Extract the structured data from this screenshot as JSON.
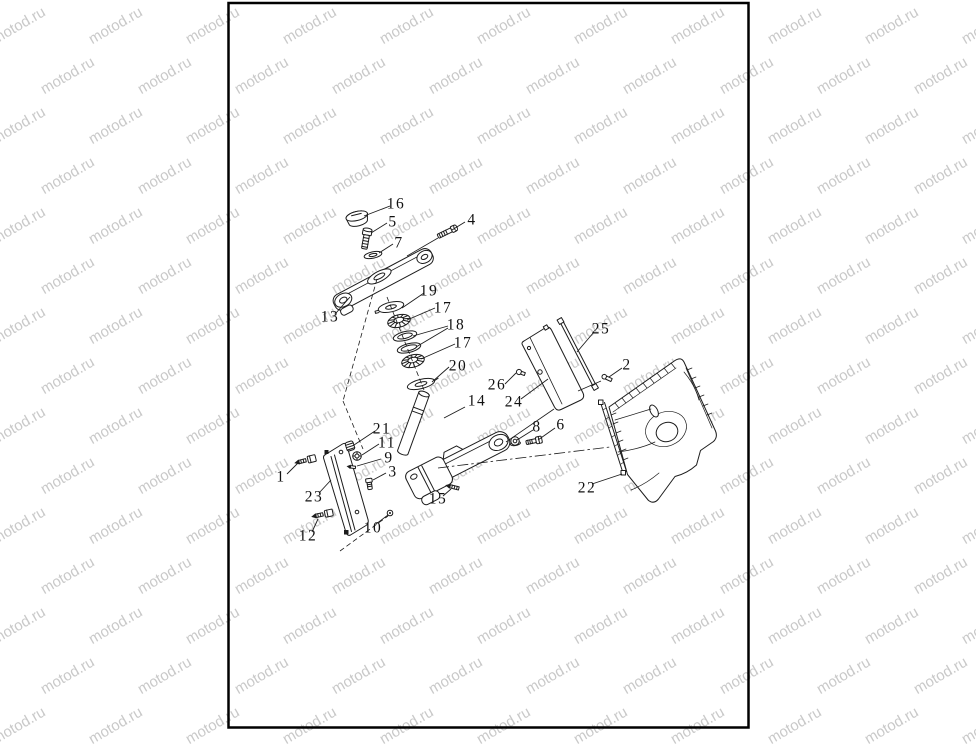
{
  "watermark": {
    "text": "motod.ru",
    "color": "#c9c9c9",
    "font_size": 15,
    "angle_deg": -30,
    "col_step": 97,
    "row_step": 50,
    "row_offset": 48,
    "cols": 12,
    "rows": 16,
    "x0": -55,
    "y0": -18
  },
  "page": {
    "background": "#ffffff",
    "border_color": "#000000"
  },
  "diagram": {
    "description": "Exploded parts view of a steering column / triple clamp assembly with numbered callouts",
    "ink": "#1c1c1c",
    "labels": [
      {
        "text": "16",
        "x": 396,
        "y": 204
      },
      {
        "text": "5",
        "x": 393,
        "y": 222
      },
      {
        "text": "4",
        "x": 472,
        "y": 220
      },
      {
        "text": "7",
        "x": 399,
        "y": 243
      },
      {
        "text": "13",
        "x": 330,
        "y": 317
      },
      {
        "text": "19",
        "x": 429,
        "y": 291
      },
      {
        "text": "17",
        "x": 443,
        "y": 308
      },
      {
        "text": "18",
        "x": 456,
        "y": 325
      },
      {
        "text": "17",
        "x": 463,
        "y": 343
      },
      {
        "text": "20",
        "x": 458,
        "y": 366
      },
      {
        "text": "25",
        "x": 601,
        "y": 329
      },
      {
        "text": "2",
        "x": 627,
        "y": 365
      },
      {
        "text": "26",
        "x": 497,
        "y": 385
      },
      {
        "text": "24",
        "x": 514,
        "y": 402
      },
      {
        "text": "14",
        "x": 477,
        "y": 401
      },
      {
        "text": "8",
        "x": 537,
        "y": 427
      },
      {
        "text": "6",
        "x": 561,
        "y": 425
      },
      {
        "text": "21",
        "x": 382,
        "y": 429
      },
      {
        "text": "11",
        "x": 387,
        "y": 443
      },
      {
        "text": "9",
        "x": 389,
        "y": 458
      },
      {
        "text": "3",
        "x": 393,
        "y": 472
      },
      {
        "text": "1",
        "x": 281,
        "y": 477
      },
      {
        "text": "23",
        "x": 314,
        "y": 497
      },
      {
        "text": "15",
        "x": 438,
        "y": 499
      },
      {
        "text": "22",
        "x": 587,
        "y": 488
      },
      {
        "text": "12",
        "x": 308,
        "y": 536
      },
      {
        "text": "10",
        "x": 373,
        "y": 528
      }
    ],
    "leaders": [
      [
        390,
        206,
        364,
        216
      ],
      [
        387,
        223,
        371,
        233
      ],
      [
        465,
        222,
        452,
        230
      ],
      [
        393,
        244,
        379,
        253
      ],
      [
        336,
        313,
        350,
        297
      ],
      [
        424,
        293,
        402,
        308
      ],
      [
        435,
        308,
        407,
        320
      ],
      [
        448,
        326,
        413,
        336
      ],
      [
        448,
        328,
        416,
        347
      ],
      [
        455,
        344,
        421,
        359
      ],
      [
        449,
        367,
        432,
        382
      ],
      [
        594,
        332,
        577,
        352
      ],
      [
        622,
        368,
        609,
        377
      ],
      [
        505,
        384,
        516,
        373
      ],
      [
        521,
        399,
        548,
        379
      ],
      [
        465,
        407,
        444,
        418
      ],
      [
        533,
        430,
        517,
        440
      ],
      [
        555,
        428,
        538,
        440
      ],
      [
        375,
        431,
        354,
        445
      ],
      [
        379,
        444,
        362,
        455
      ],
      [
        381,
        459,
        357,
        466
      ],
      [
        386,
        473,
        373,
        480
      ],
      [
        287,
        474,
        298,
        463
      ],
      [
        319,
        493,
        331,
        480
      ],
      [
        443,
        496,
        451,
        489
      ],
      [
        592,
        484,
        622,
        474
      ],
      [
        312,
        532,
        318,
        519
      ],
      [
        376,
        524,
        388,
        515
      ]
    ],
    "dashed_lines": [
      [
        377,
        279,
        343,
        401
      ],
      [
        343,
        401,
        363,
        449
      ],
      [
        387,
        297,
        424,
        390
      ],
      [
        340,
        551,
        388,
        516
      ]
    ],
    "dashdot_lines": [
      [
        438,
        468,
        610,
        447
      ]
    ],
    "assoc_lines": [
      [
        554,
        409,
        506,
        442
      ],
      [
        438,
        238,
        407,
        256
      ],
      [
        601,
        381,
        578,
        391
      ]
    ]
  }
}
